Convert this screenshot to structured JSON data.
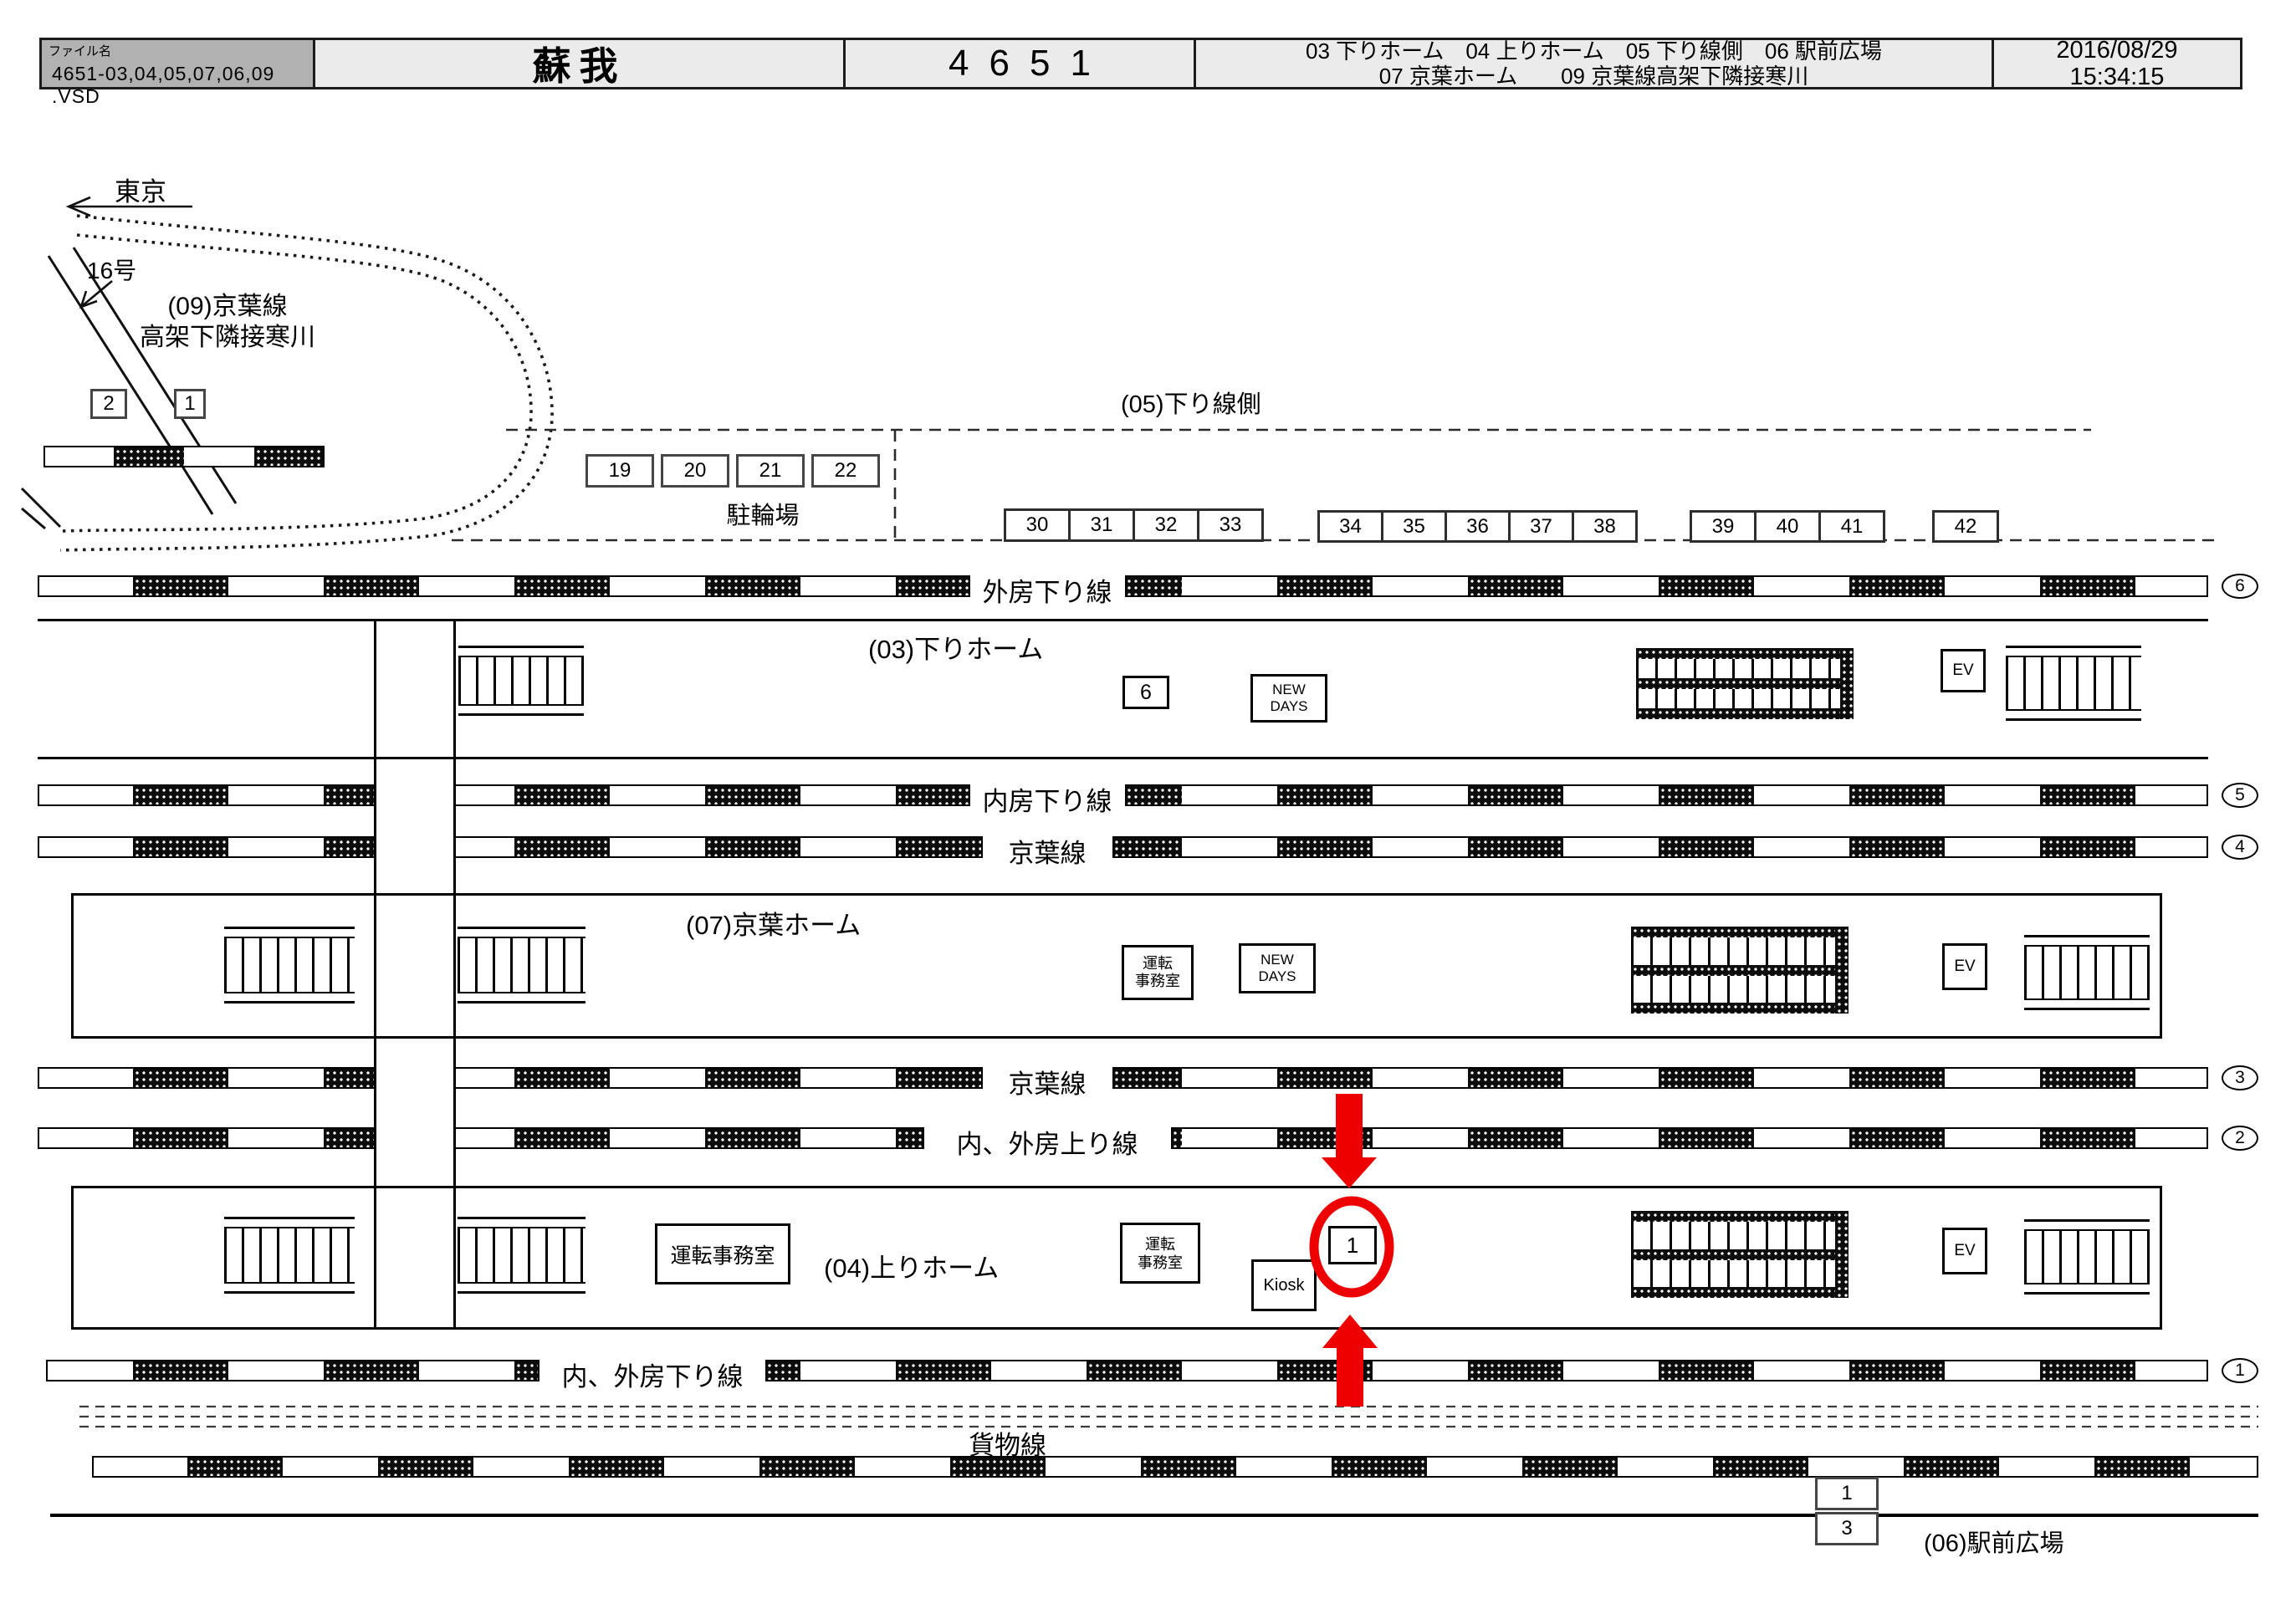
{
  "header": {
    "file_label": "ファイル名",
    "file_name": "4651-03,04,05,07,06,09 .VSD",
    "station_title": "蘇我",
    "sheet_number": "4651",
    "legend_line1": "03 下りホーム　04 上りホーム　05 下り線側　06 駅前広場",
    "legend_line2": "07 京葉ホーム　　09 京葉線高架下隣接寒川",
    "date": "2016/08/29",
    "time": "15:34:15"
  },
  "map": {
    "direction_label": "東京",
    "route_label": "16号",
    "area09_line1": "(09)京葉線",
    "area09_line2": "高架下隣接寒川",
    "zone05_label": "(05)下り線側",
    "bicycle_label": "駐輪場",
    "platform03_label": "(03)下りホーム",
    "platform07_label": "(07)京葉ホーム",
    "platform04_label": "(04)上りホーム",
    "freight_label": "貨物線",
    "zone06_label": "(06)駅前広場",
    "tracks": [
      {
        "label": "外房下り線",
        "circle": "6"
      },
      {
        "label": "内房下り線",
        "circle": "5"
      },
      {
        "label": "京葉線",
        "circle": "4"
      },
      {
        "label": "京葉線",
        "circle": "3"
      },
      {
        "label": "内、外房上り線",
        "circle": "2"
      },
      {
        "label": "内、外房下り線",
        "circle": "1"
      }
    ],
    "boxes": {
      "corner": [
        "2",
        "1"
      ],
      "bike": [
        "19",
        "20",
        "21",
        "22"
      ],
      "row_a": [
        "30",
        "31",
        "32",
        "33"
      ],
      "row_b": [
        "34",
        "35",
        "36",
        "37",
        "38"
      ],
      "row_c": [
        "39",
        "40",
        "41"
      ],
      "row_d": [
        "42"
      ],
      "platform03_number": "6",
      "highlight_number": "1",
      "plaza": [
        "1",
        "3"
      ]
    },
    "facility": {
      "ev": "EV",
      "kiosk": "Kiosk",
      "newdays_line1": "NEW",
      "newdays_line2": "DAYS",
      "office": "運転事務室",
      "office_line1": "運転",
      "office_line2": "事務室"
    },
    "highlight_color": "#ee0000"
  }
}
